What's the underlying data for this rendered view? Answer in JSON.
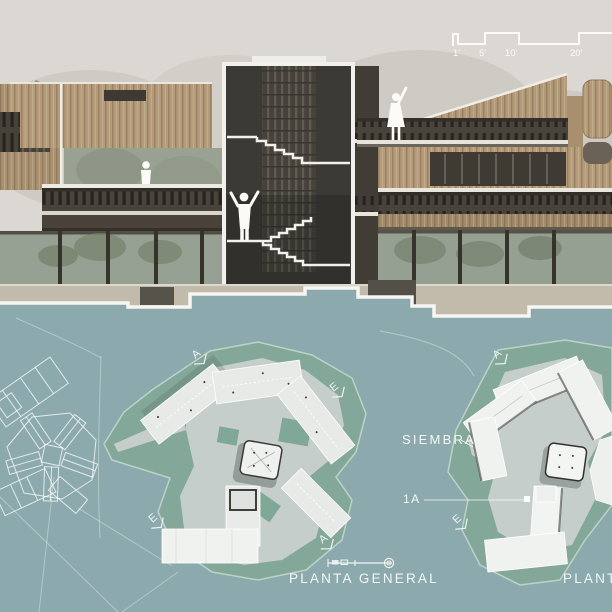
{
  "section": {
    "scale_bar": {
      "labels": [
        "1'",
        "5'",
        "10'",
        "20'"
      ]
    }
  },
  "plan": {
    "site_label": "SIEMBRA",
    "unit_label": "1A",
    "caption_primary": "PLANTA GENERAL",
    "caption_secondary": "PLANTA",
    "markers": [
      {
        "letter": "A"
      },
      {
        "letter": "E"
      },
      {
        "letter": "E"
      },
      {
        "letter": "A"
      },
      {
        "letter": "A"
      },
      {
        "letter": "E"
      }
    ]
  },
  "colors": {
    "sky": "#dbd8d3",
    "plan_teal": "#8caaad",
    "site_green": "#83a89a",
    "plaza_gray": "#c6cecb",
    "building_tan": "#b49b79",
    "railing_dark": "#48443b",
    "label_white": "#f4f7f6"
  }
}
